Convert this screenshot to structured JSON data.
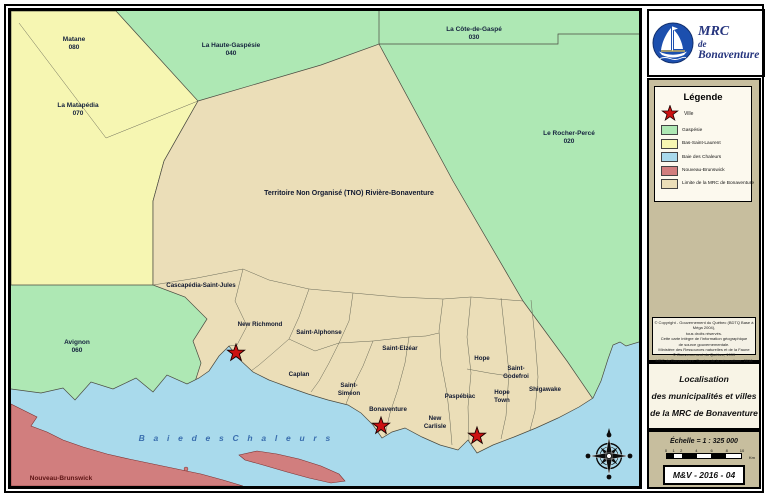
{
  "logo": {
    "org": "MRC",
    "de": "de",
    "name": "Bonaventure"
  },
  "legend": {
    "title": "Légende",
    "ville_label": "Ville",
    "items": [
      {
        "label": "Gaspésie",
        "color": "#aee8b4"
      },
      {
        "label": "Bas-Saint-Laurent",
        "color": "#f6f6b2"
      },
      {
        "label": "Baie des Chaleurs",
        "color": "#a9daec"
      },
      {
        "label": "Nouveau-Brunswick",
        "color": "#d17e7e"
      },
      {
        "label": "Limite de la MRC de Bonaventure",
        "color": "#ebdeb8"
      }
    ]
  },
  "copyright_lines": [
    "© Copyright - Gouvernement du Québec (BDTQ Base à Méga 2004),",
    "tous droits réservés.",
    "Cette carte intègre de l'information géographique",
    "de source gouvernementale.",
    "Ministère des Ressources naturelles et de la Faune",
    "© Gouvernement du Québec, 1999",
    "MRC de Bonaventure, Service de la géomatique, 2016"
  ],
  "title_block": {
    "line1": "Localisation",
    "line2": "des municipalités et villes",
    "line3": "de la MRC de Bonaventure"
  },
  "scale": {
    "label": "Échelle = 1 : 325 000",
    "ticks": [
      "0",
      "1",
      "2",
      "4",
      "6",
      "8",
      "10"
    ],
    "unit": "Km"
  },
  "map_code": "M&V - 2016 - 04",
  "map": {
    "tno_label": "Territoire Non Organisé (TNO) Rivière-Bonaventure",
    "bay_label": "B a i e   d e s   C h a l e u r s",
    "nb_label": "Nouveau-Brunswick",
    "regions": [
      {
        "name": "Matane",
        "code": "080"
      },
      {
        "name": "La Matapédia",
        "code": "070"
      },
      {
        "name": "La Haute-Gaspésie",
        "code": "040"
      },
      {
        "name": "La Côte-de-Gaspé",
        "code": "030"
      },
      {
        "name": "Le Rocher-Percé",
        "code": "020"
      },
      {
        "name": "Avignon",
        "code": "060"
      }
    ],
    "municipalities": [
      {
        "l1": "Cascapédia-Saint-Jules"
      },
      {
        "l1": "New Richmond"
      },
      {
        "l1": "Saint-Alphonse"
      },
      {
        "l1": "Caplan"
      },
      {
        "l1": "Saint-",
        "l2": "Siméon"
      },
      {
        "l1": "Saint-Elzéar"
      },
      {
        "l1": "Bonaventure"
      },
      {
        "l1": "New",
        "l2": "Carlisle"
      },
      {
        "l1": "Paspébiac"
      },
      {
        "l1": "Hope"
      },
      {
        "l1": "Hope",
        "l2": "Town"
      },
      {
        "l1": "Saint-",
        "l2": "Godefroi"
      },
      {
        "l1": "Shigawake"
      }
    ],
    "colors": {
      "gaspesie_green": "#aee8b4",
      "bas_saint_laurent_yellow": "#f6f6b2",
      "mrc_beige": "#ebdeb8",
      "water_blue": "#a9daec",
      "nouveau_brunswick_pink": "#d17e7e",
      "star_red": "#cc1111",
      "logo_navy": "#26357e",
      "sidebar_tan": "#c7be9e"
    }
  }
}
